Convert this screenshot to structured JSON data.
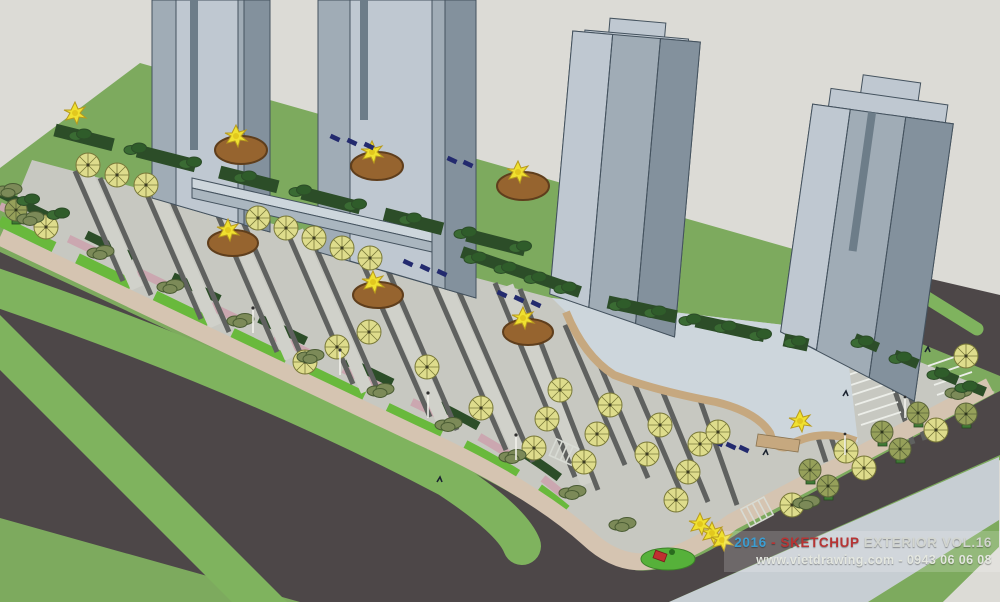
{
  "watermark": {
    "year": "2016",
    "separator": " - ",
    "brand": "SKETCHUP",
    "title_rest": " EXTERIOR VOL.16",
    "line2": "www.vietdrawing.com - 0943 06 06 08"
  },
  "colors": {
    "sky": "#dcdbd6",
    "lawn": "#7daa5e",
    "lawn_bright": "#69b93c",
    "road": "#4d4748",
    "median": "#7fb35e",
    "paving": "#c7c8c1",
    "paving_light": "#d0d1ca",
    "strip": "#5f615f",
    "sidewalk": "#d5c4b1",
    "pink": "#cba7b0",
    "hedge": "#2c4d28",
    "shrub": "#7c8a58",
    "shrub_dk": "#4a5c33",
    "planter": "#96642f",
    "planter_rim": "#5f3e1c",
    "tree_yellow": "#f0e130",
    "tree_yellow_dk": "#b89b1e",
    "umb_yellow": "#dedc8c",
    "umb_olive": "#96a05a",
    "umb_line": "#7a7a3a",
    "bench": "#232a6e",
    "tower_light": "#bfc8d1",
    "tower_mid": "#a0acb6",
    "tower_dark": "#83919d",
    "tower_line": "#44525e",
    "podium": "#cdd6dc",
    "curve": "#c6a87f",
    "park_line": "#eceee9",
    "pale": "#c7ced3",
    "wm_blue": "#3b9dd1",
    "wm_red": "#b73434",
    "wm_gray": "#d2d5cf",
    "play": "#56b13a",
    "slide": "#c03030",
    "trellis": "#d8dbd4",
    "pole": "#f0f0ea"
  },
  "scene": {
    "subject": "Aerial SketchUp-style render of a residential complex streetscape",
    "objects": {
      "highrise_towers": 4,
      "round_tree_planters": 6,
      "parasols": 38,
      "benches": 14,
      "roads": "perimeter asphalt roads with green medians",
      "parking": "angled stalls with white stripes",
      "playground": "red slide on bright green patch"
    }
  }
}
